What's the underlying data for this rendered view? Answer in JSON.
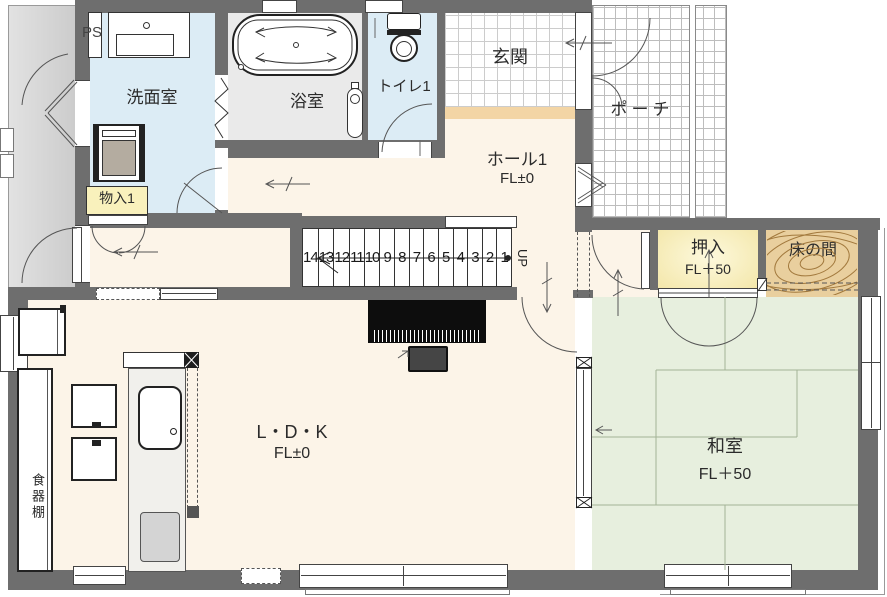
{
  "drawing": {
    "title": "1F floor plan",
    "rooms": {
      "ps": {
        "label": "PS"
      },
      "washroom": {
        "label": "洗面室"
      },
      "bathroom": {
        "label": "浴室"
      },
      "toilet": {
        "label": "トイレ1"
      },
      "entrance": {
        "label": "玄関"
      },
      "porch": {
        "label": "ポーチ"
      },
      "hall": {
        "label": "ホール1",
        "level": "FL±0"
      },
      "storage1": {
        "label": "物入1"
      },
      "closet": {
        "label": "押入",
        "level": "FL＋50"
      },
      "tokonoma": {
        "label": "床の間"
      },
      "ldk": {
        "label": "L・D・K",
        "level": "FL±0"
      },
      "japanese_room": {
        "label": "和室",
        "level": "FL＋50"
      },
      "cupboard": {
        "label": "食器棚"
      }
    },
    "stairs": {
      "up_label": "UP",
      "numbers": [
        "14",
        "13",
        "12",
        "11",
        "10",
        "9",
        "8",
        "7",
        "6",
        "5",
        "4",
        "3",
        "2",
        "1"
      ]
    },
    "colors": {
      "wall": "#6e6e6e",
      "floor_wood": "#fcf4e8",
      "water_rooms": "#dcecf5",
      "bath_floor": "#eaeaea",
      "closet_yellow": "#f9f1bc",
      "tokonoma_wood": "#e9cf9e",
      "tatami_green": "#e7efde",
      "entry_step": "#f3d5a5",
      "outside_passage": "#d8d8d8"
    }
  }
}
